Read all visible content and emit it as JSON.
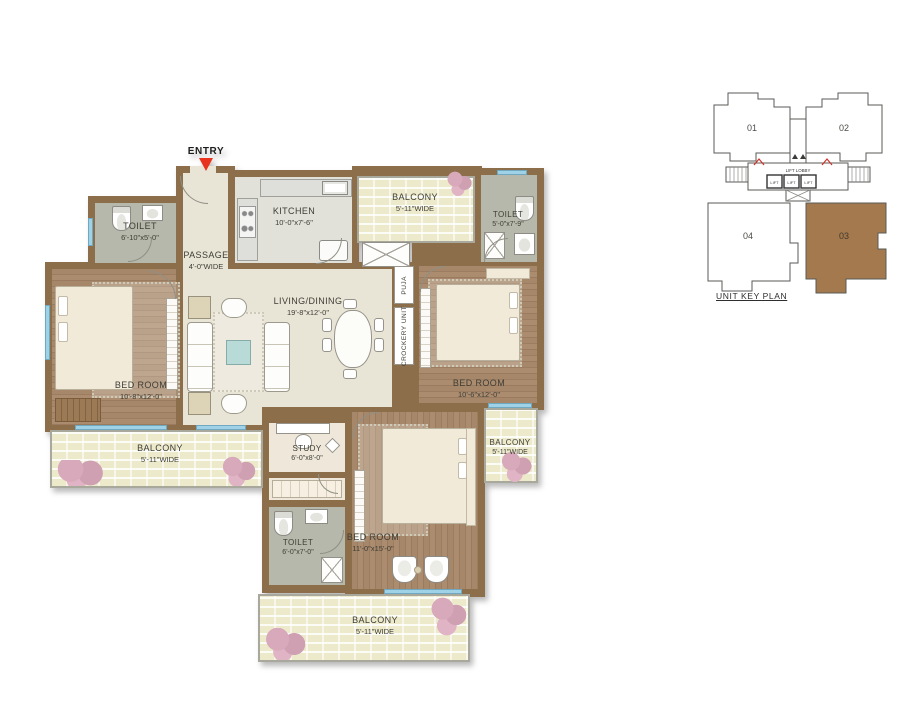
{
  "floor_plan": {
    "entry_label": "ENTRY",
    "rooms": {
      "passage": {
        "name": "PASSAGE",
        "dim": "4'-0\"WIDE"
      },
      "kitchen": {
        "name": "KITCHEN",
        "dim": "10'-0\"x7'-6\""
      },
      "balcony_top": {
        "name": "BALCONY",
        "dim": "5'-11\"WIDE"
      },
      "toilet_top_right": {
        "name": "TOILET",
        "dim": "5'-0\"x7'-9\""
      },
      "toilet_left": {
        "name": "TOILET",
        "dim": "6'-10\"x5'-0\""
      },
      "living_dining": {
        "name": "LIVING/DINING",
        "dim": "19'-8\"x12'-0\""
      },
      "bed_left": {
        "name": "BED ROOM",
        "dim": "10'-8\"x12'-0\""
      },
      "bed_right": {
        "name": "BED ROOM",
        "dim": "10'-6\"x12'-0\""
      },
      "study": {
        "name": "STUDY",
        "dim": "6'-0\"x8'-0\""
      },
      "balcony_left": {
        "name": "BALCONY",
        "dim": "5'-11\"WIDE"
      },
      "balcony_right": {
        "name": "BALCONY",
        "dim": "5'-11\"WIDE"
      },
      "toilet_bottom": {
        "name": "TOILET",
        "dim": "6'-0\"x7'-0\""
      },
      "bed_bottom": {
        "name": "BED ROOM",
        "dim": "11'-0\"x15'-0\""
      },
      "balcony_bottom": {
        "name": "BALCONY",
        "dim": "5'-11\"WIDE"
      }
    },
    "fixtures": {
      "puja": "PUJA",
      "crockery_unit": "CROCKERY UNIT"
    }
  },
  "key_plan": {
    "title": "UNIT KEY PLAN",
    "units": {
      "u01": "01",
      "u02": "02",
      "u03": "03",
      "u04": "04"
    },
    "lift_lobby": "LIFT LOBBY",
    "lift": "LIFT",
    "highlighted_unit": "03"
  },
  "colors": {
    "wall": "#8d6e4b",
    "wood_floor": "#a3866a",
    "living_floor": "#e9e5d6",
    "balcony_floor": "#edeacc",
    "toilet_floor": "#b5b8aa",
    "kitchen_floor": "#e2e1d9",
    "entry_arrow": "#e8331f",
    "key_plan_highlight": "#a3794d"
  }
}
